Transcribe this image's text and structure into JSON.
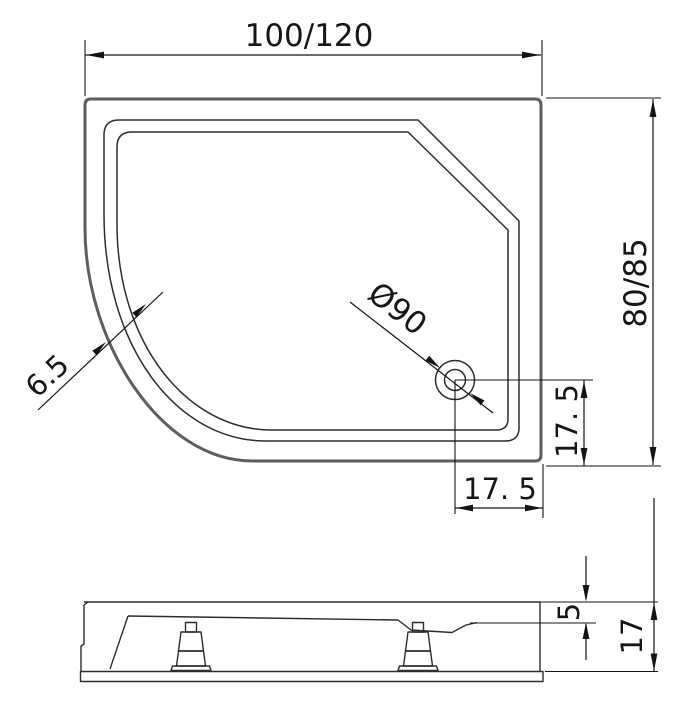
{
  "drawing": {
    "background": "#ffffff",
    "colors": {
      "outline": "#5e5e5e",
      "line": "#2d2d2d",
      "dimension": "#141414"
    },
    "top_view": {
      "width_label": "100/120",
      "depth_label": "80/85",
      "drain_label": "Ø90",
      "rim_label": "6.5",
      "drain_offset_vertical_label": "17. 5",
      "drain_offset_horizontal_label": "17. 5"
    },
    "side_view": {
      "lip_height_label": "5",
      "total_height_label": "17"
    }
  }
}
